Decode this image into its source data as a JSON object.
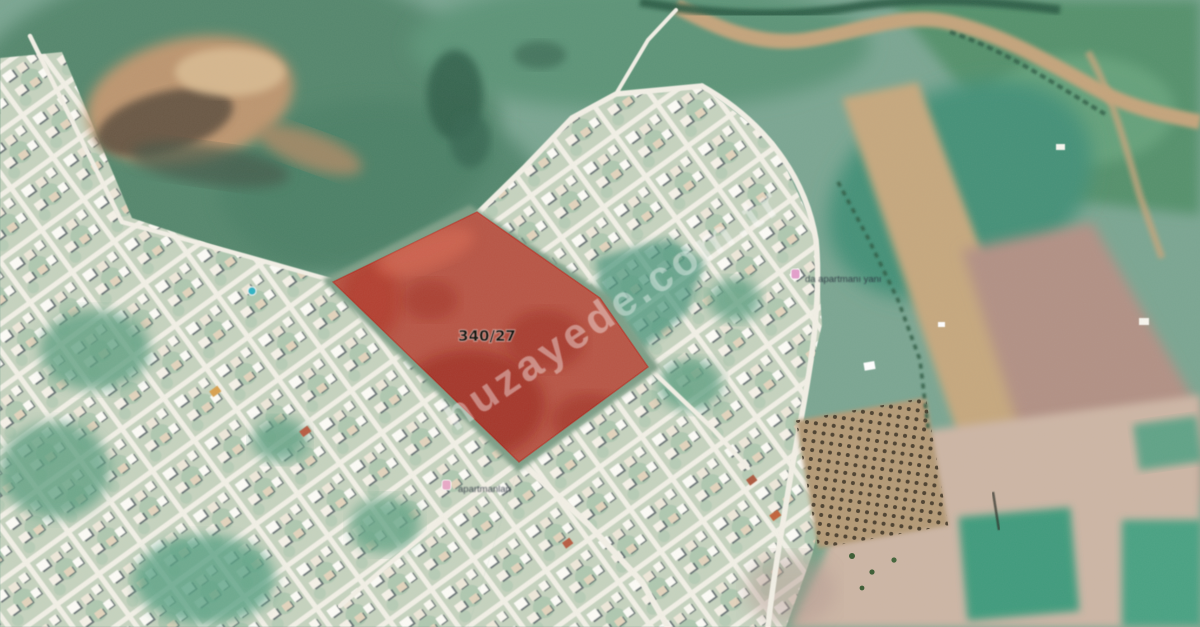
{
  "map": {
    "parcel_label": "340/27",
    "watermark": "huzayede.com.tr",
    "place_labels": {
      "label_1": "da apartmanı yanı",
      "label_2": "apartmanları"
    },
    "colors": {
      "parcel_fill": "#e0251b",
      "road": "#f3f0e6",
      "suburb_ground": "#c6d3bf",
      "field_green": "#5e9a7d",
      "farm_tan": "#c6a87e",
      "farm_mauve": "#b29185",
      "watermark": "#ffffff"
    }
  }
}
